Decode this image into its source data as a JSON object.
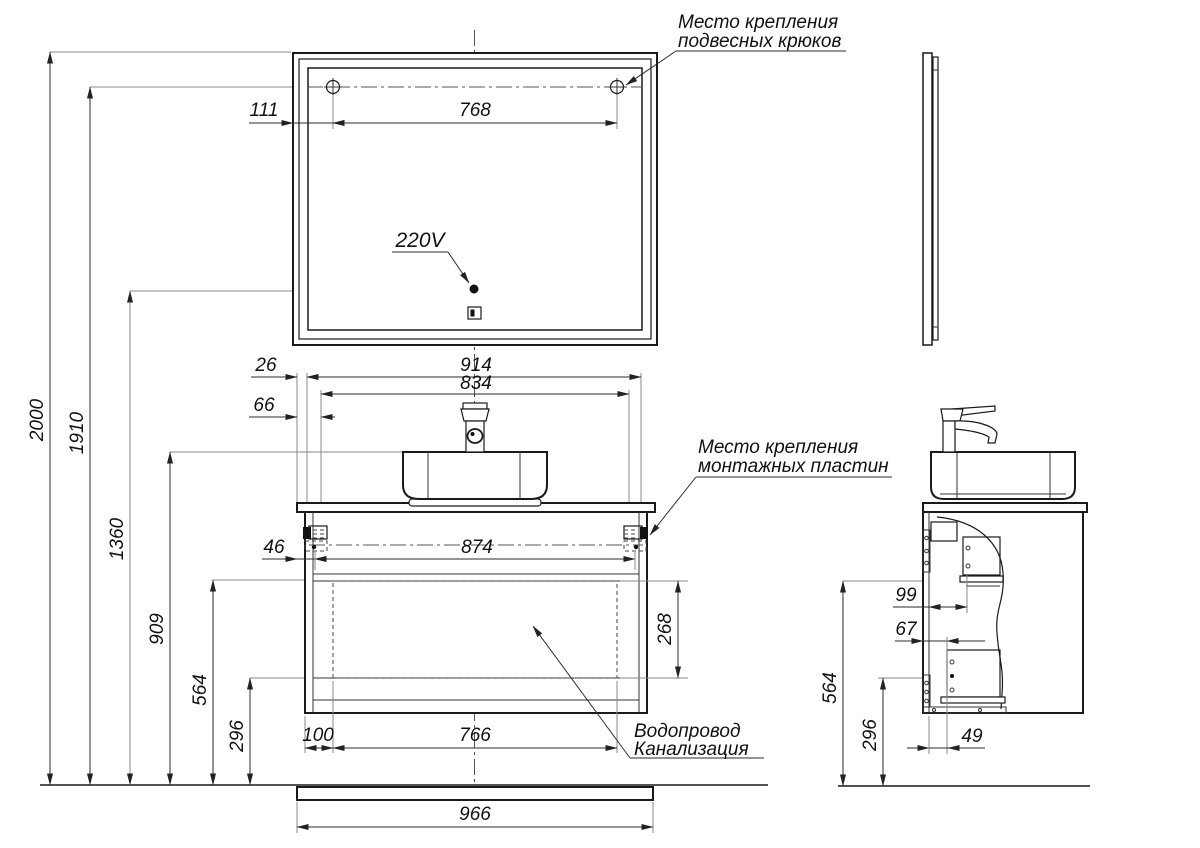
{
  "dims": {
    "d2000": "2000",
    "d1910": "1910",
    "d1360": "1360",
    "d909": "909",
    "d564": "564",
    "d296": "296",
    "d111": "111",
    "d768": "768",
    "d26": "26",
    "d914": "914",
    "d834": "834",
    "d66": "66",
    "d46": "46",
    "d874": "874",
    "d268": "268",
    "d100": "100",
    "d766": "766",
    "d966": "966",
    "d99": "99",
    "d67": "67",
    "d49": "49"
  },
  "labels": {
    "voltage": "220V",
    "hooks_note_line1": "Место крепления",
    "hooks_note_line2": "подвесных крюков",
    "plates_note_line1": "Место крепления",
    "plates_note_line2": "монтажных пластин",
    "utility_note_line1": "Водопровод",
    "utility_note_line2": "Канализация"
  }
}
